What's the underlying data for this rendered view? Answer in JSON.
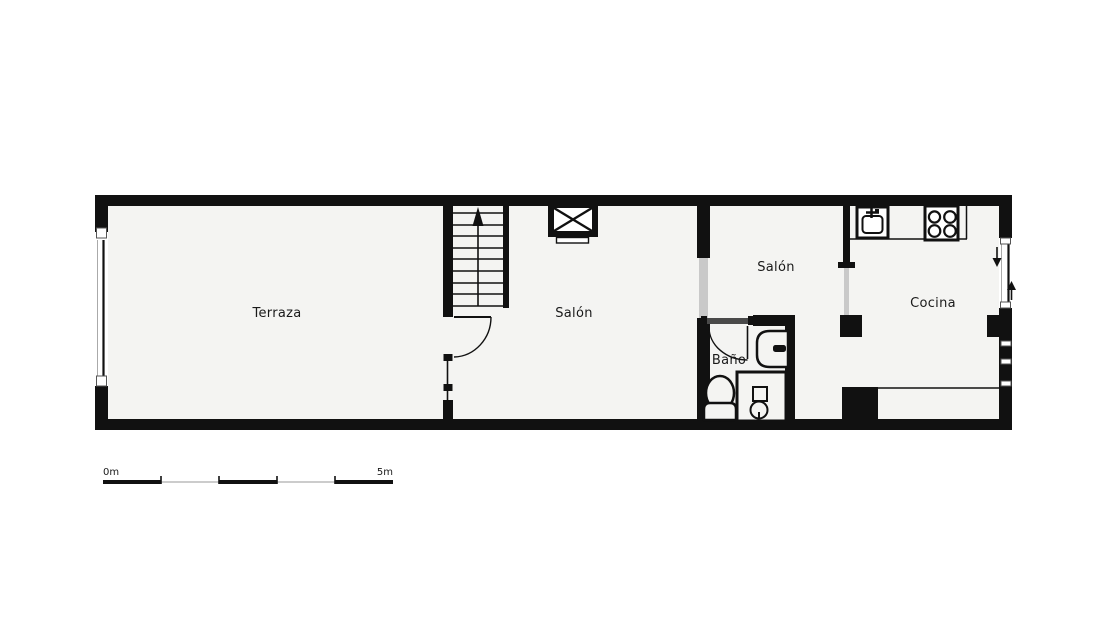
{
  "rooms": [
    {
      "id": "terraza",
      "label": "Terraza"
    },
    {
      "id": "salon-main",
      "label": "Salón"
    },
    {
      "id": "salon-small",
      "label": "Salón"
    },
    {
      "id": "bano",
      "label": "Baño"
    },
    {
      "id": "cocina",
      "label": "Cocina"
    }
  ],
  "scale_bar": {
    "start_label": "0m",
    "end_label": "5m"
  },
  "icons": {
    "stairs": "stairs-with-up-arrow",
    "elevator": "elevator-shaft-x-box",
    "kitchen_sink": "kitchen-sink",
    "stove": "four-burner-stove",
    "washbasin": "washbasin",
    "toilet": "toilet",
    "shower": "shower-with-drain",
    "entry_arrows": "down-and-up-direction-arrows"
  },
  "colors": {
    "wall": "#111111",
    "room_fill": "#f4f4f2",
    "opening": "#c9c9c9",
    "door_header": "#4a4a4a",
    "text": "#1a1a1a",
    "scale_thin": "#999999",
    "glass_gray": "#aaaaaa"
  }
}
